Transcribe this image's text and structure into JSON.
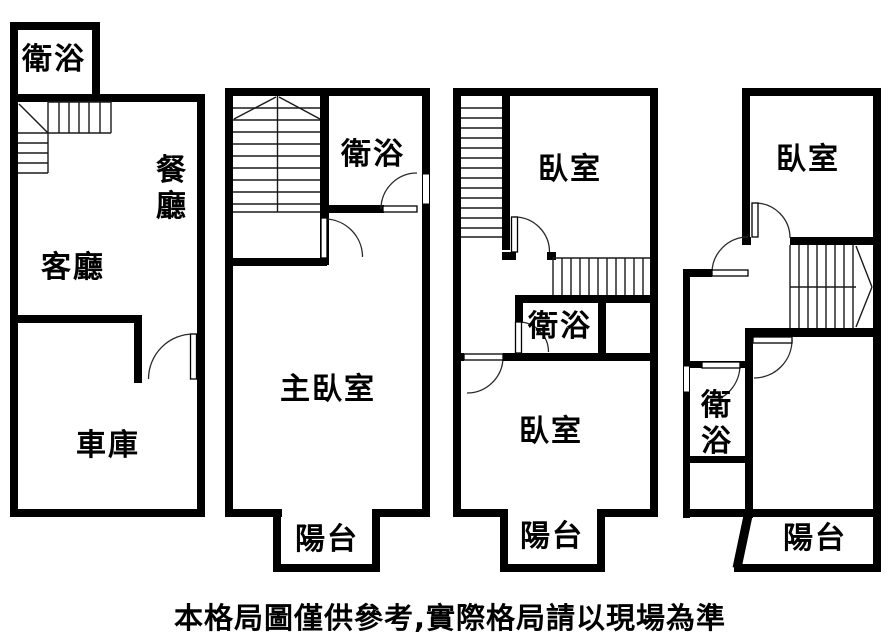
{
  "floors": [
    {
      "rooms": {
        "bathroom": "衛浴",
        "dining": "餐廳",
        "living": "客廳",
        "garage": "車庫"
      }
    },
    {
      "rooms": {
        "bathroom": "衛浴",
        "master_bedroom": "主臥室",
        "balcony": "陽台"
      }
    },
    {
      "rooms": {
        "bedroom_upper": "臥室",
        "bathroom": "衛浴",
        "bedroom_lower": "臥室",
        "balcony": "陽台"
      }
    },
    {
      "rooms": {
        "bedroom": "臥室",
        "bathroom": "衛浴",
        "balcony": "陽台"
      }
    }
  ],
  "disclaimer": "本格局圖僅供參考,實際格局請以現場為準",
  "colors": {
    "wall": "#000000",
    "background": "#ffffff",
    "thin_line": "#1a1a1a"
  }
}
